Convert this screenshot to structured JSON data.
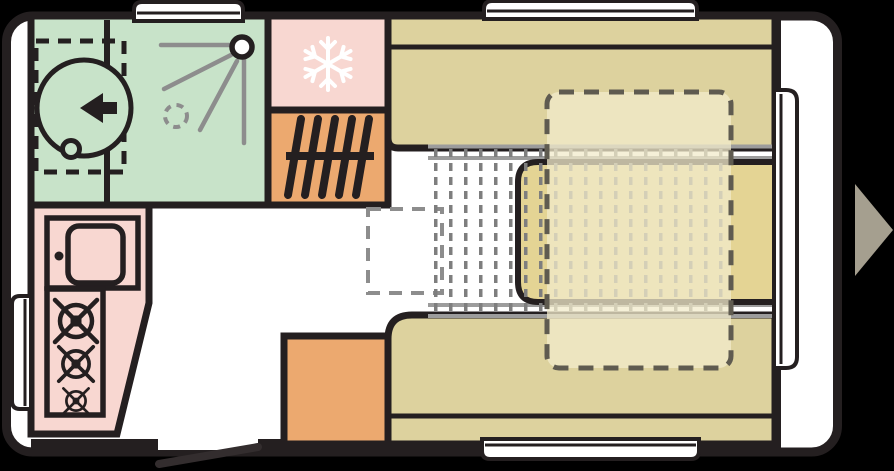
{
  "diagram": {
    "type": "caravan-floor-plan",
    "description": "Top-view caravan floor plan, entrance door open on lower wall, travel-direction arrow at right",
    "width_px": 894,
    "height_px": 471
  },
  "colors": {
    "bg": "#000000",
    "floor": "#ffffff",
    "line": "#241f20",
    "bathroom": "#c8e3c9",
    "pink": "#f8d7d1",
    "orange": "#eca96f",
    "bench": "#ddd29e",
    "table": "#e4d494",
    "overlay": "rgba(242,235,203,0.75)",
    "overlay-line": "#5f5b50",
    "gray": "#8d8d8d",
    "rail": "#9c9c9c",
    "texture": "#7e7e7e",
    "door-leaf": "#332d2e",
    "arrow": "#a59f8f",
    "white": "#ffffff"
  },
  "areas": [
    {
      "name": "bathroom",
      "features": [
        "swivel-toilet",
        "toilet-clearance-dashed-zone",
        "shower-head",
        "shower-spray-rays",
        "shower-drain"
      ],
      "fill": "bathroom"
    },
    {
      "name": "fridge",
      "features": [
        "snowflake-icon"
      ],
      "fill": "pink"
    },
    {
      "name": "heater",
      "features": [
        "heater-grille-icon"
      ],
      "fill": "orange"
    },
    {
      "name": "kitchen",
      "features": [
        "sink",
        "faucet",
        "stove-three-burners"
      ],
      "fill": "pink"
    },
    {
      "name": "wardrobe",
      "features": [],
      "fill": "orange"
    },
    {
      "name": "lounge-bench-top",
      "features": [
        "backrest-strip"
      ],
      "fill": "bench"
    },
    {
      "name": "lounge-bench-bottom",
      "features": [
        "backrest-strip"
      ],
      "fill": "bench"
    },
    {
      "name": "table",
      "features": [
        "slide-rails"
      ],
      "fill": "table"
    },
    {
      "name": "bed-made-up-overlay",
      "features": [
        "dashed-outline"
      ],
      "fill": "overlay"
    },
    {
      "name": "bed-slat-area",
      "features": [
        "dash-texture"
      ],
      "fill": "texture"
    },
    {
      "name": "table-stowed-position",
      "features": [
        "dashed-outline"
      ],
      "fill": "none"
    }
  ],
  "openings": [
    {
      "name": "window-top-left",
      "wall": "top"
    },
    {
      "name": "window-top-right",
      "wall": "top"
    },
    {
      "name": "window-left",
      "wall": "left"
    },
    {
      "name": "window-bottom",
      "wall": "bottom"
    },
    {
      "name": "front-window",
      "wall": "right"
    },
    {
      "name": "entrance-door-open",
      "wall": "bottom"
    }
  ],
  "icons": [
    "snowflake-icon",
    "heater-grille-icon",
    "toilet-arrow-icon",
    "shower-icon",
    "sink-icon",
    "burner-icon",
    "travel-direction-arrow-icon"
  ]
}
